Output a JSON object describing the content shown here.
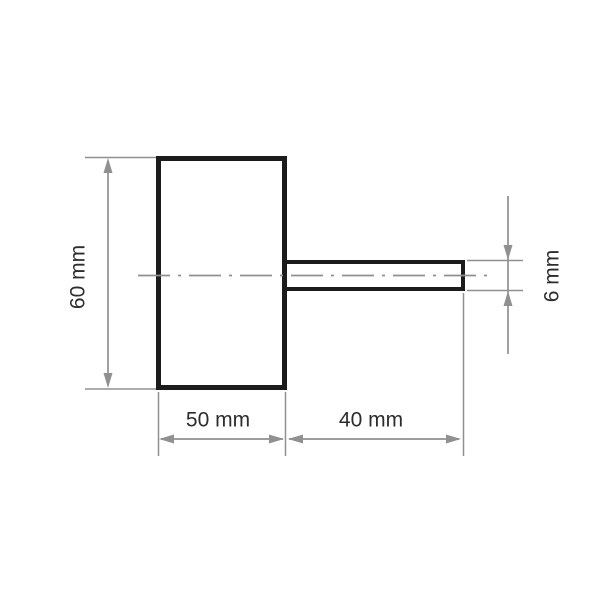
{
  "drawing": {
    "kind": "technical-dimension-drawing",
    "labels": {
      "overall_height": "60 mm",
      "body_width": "50 mm",
      "shank_length": "40 mm",
      "shank_diameter": "6 mm"
    }
  },
  "colors": {
    "background": "#ffffff",
    "outline": "#1c1c1c",
    "dimension": "#909090",
    "text": "#2d2d2d"
  }
}
